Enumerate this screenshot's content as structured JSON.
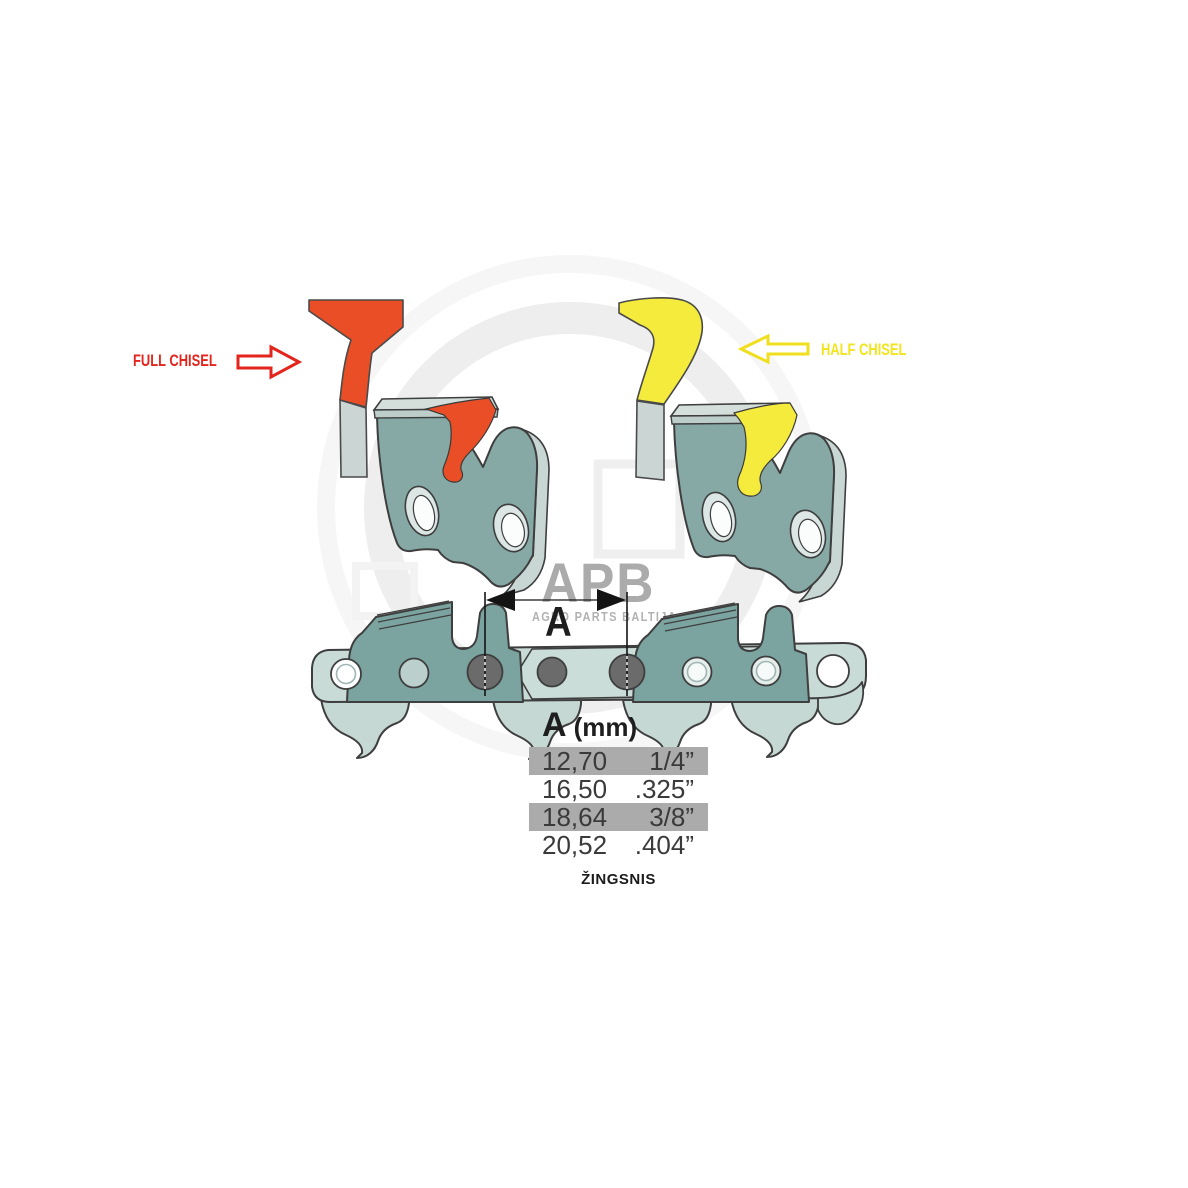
{
  "image": {
    "width": 1188,
    "height": 1188,
    "background": "#ffffff"
  },
  "watermark": {
    "brand": "APB",
    "tagline": "AGRO PARTS BALTIJA",
    "color": "#ababab"
  },
  "annotations": {
    "full_chisel": {
      "label": "FULL CHISEL",
      "color": "#e3251d"
    },
    "half_chisel": {
      "label": "HALF CHISEL",
      "color": "#f2e41e"
    }
  },
  "dimension": {
    "label": "A"
  },
  "pitch_table": {
    "header": {
      "letter": "A",
      "unit": "(mm)"
    },
    "rows": [
      {
        "mm": "12,70",
        "inches": "1/4”",
        "highlighted": true
      },
      {
        "mm": "16,50",
        "inches": ".325”",
        "highlighted": false
      },
      {
        "mm": "18,64",
        "inches": "3/8”",
        "highlighted": true
      },
      {
        "mm": "20,52",
        "inches": ".404”",
        "highlighted": false
      }
    ],
    "highlight_color": "#ababab",
    "caption": "ŽINGSNIS"
  },
  "colors": {
    "full_chisel_red": "#e94e26",
    "half_chisel_yellow": "#f5eb3c",
    "cutter_link_teal": "#86a9a6",
    "chain_light_teal": "#c9dbd7",
    "steel_gray": "#cbd6d4",
    "rivet_gray": "#6b6b6b",
    "outline": "#3e3e3e"
  }
}
